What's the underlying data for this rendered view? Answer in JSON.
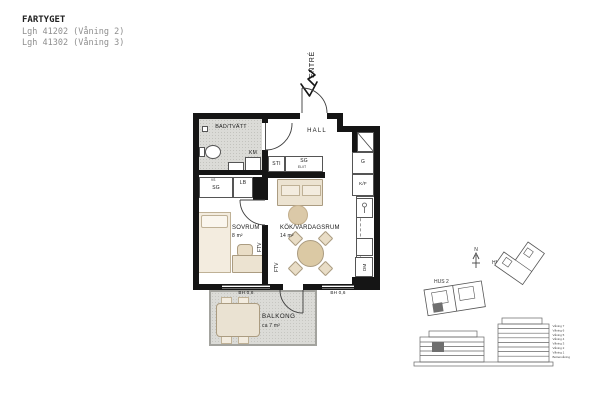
{
  "header": {
    "project": "FARTYGET",
    "apartments": [
      "Lgh 41202 (Våning 2)",
      "Lgh 41302 (Våning 3)"
    ]
  },
  "plan": {
    "entry": "ENTRÉ",
    "bathroom": {
      "name": "BAD/TVÄTT",
      "washer": "KM"
    },
    "hall": {
      "name": "HALL",
      "closet_sti": "STI",
      "closet_sg": "SG",
      "closet_sg_sub": "EL/IT"
    },
    "bedroom": {
      "name": "SOVRUM",
      "area": "8 m²",
      "closet_vs": "VS",
      "closet_sg": "SG",
      "closet_lb": "LB",
      "tv_outlet": "FTV"
    },
    "kitchen": {
      "name": "KÖK/VARDAGSRUM",
      "area": "14 m²",
      "wardrobe": "G",
      "fridge_freezer": "K/F",
      "dishwasher": "DM",
      "tv_outlet": "FTV"
    },
    "balcony": {
      "name": "BALKONG",
      "area": "ca 7 m²"
    },
    "sill_left": "BH 0,6",
    "sill_right": "BH 0,6"
  },
  "site": {
    "hus1": "HUS 1",
    "hus2": "HUS 2",
    "north": "N",
    "floors": [
      "Våning 7",
      "Våning 6",
      "Våning 5",
      "Våning 4",
      "Våning 3",
      "Våning 2",
      "Våning 1",
      "Bottenvåning"
    ]
  },
  "colors": {
    "wall": "#151515",
    "floor_gray": "#dbdbd7",
    "furniture_beige": "#ece3d1",
    "marker_gray": "#6f6f6f",
    "muted_text": "#8e8e8e"
  }
}
